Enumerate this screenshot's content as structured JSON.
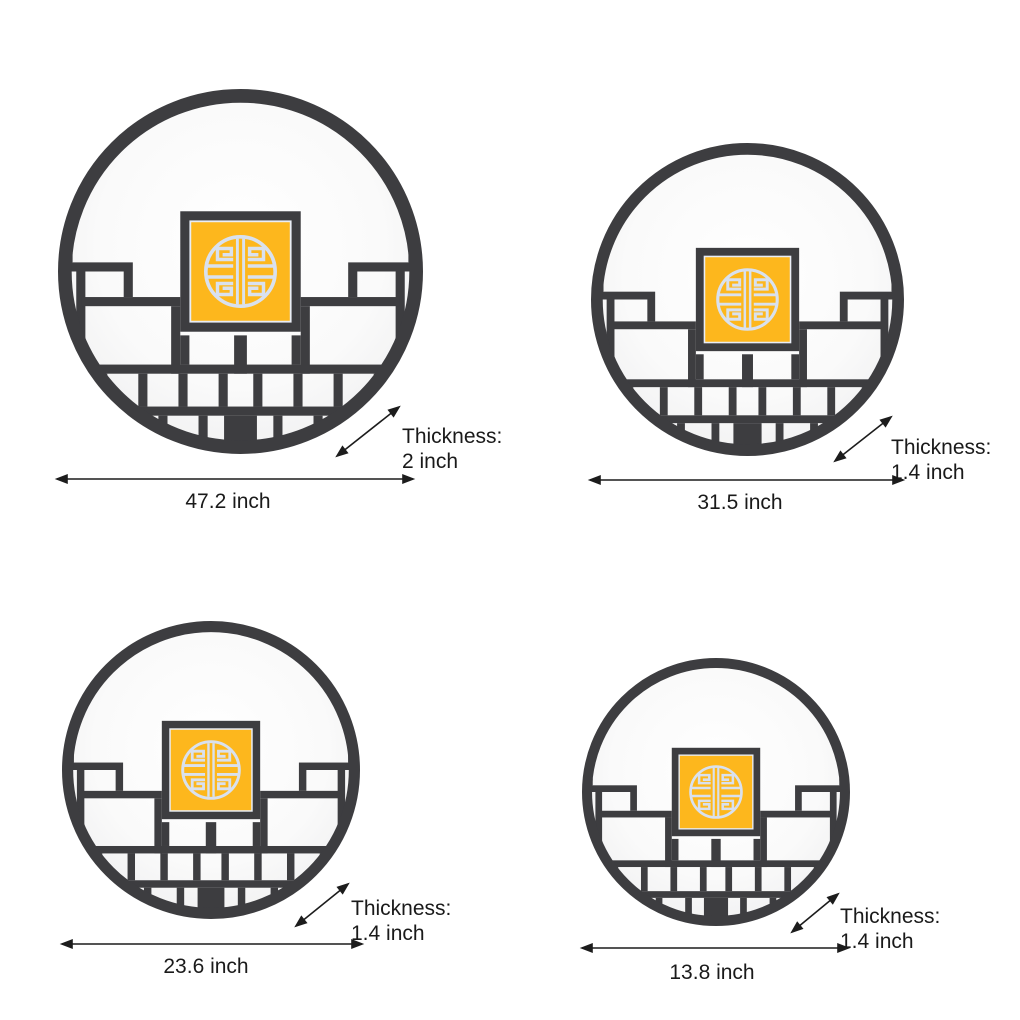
{
  "colors": {
    "frame_charcoal": "#3d3d40",
    "panel_yellow": "#fdb71d",
    "shou_symbol": "#d9e1ee",
    "inner_glow": "#ffffff",
    "inner_edge": "#e9e9eb",
    "annotation_ink": "#1a1a1a"
  },
  "icons": {
    "lamp_motif": "shou-longevity-medallion-icon",
    "arrows": "double-headed-dimension-arrow"
  },
  "products": [
    {
      "position": "top-left",
      "width_label": "47.2 inch",
      "thickness_title": "Thickness:",
      "thickness_value": "2 inch"
    },
    {
      "position": "top-right",
      "width_label": "31.5 inch",
      "thickness_title": "Thickness:",
      "thickness_value": "1.4 inch"
    },
    {
      "position": "bottom-left",
      "width_label": "23.6 inch",
      "thickness_title": "Thickness:",
      "thickness_value": "1.4 inch"
    },
    {
      "position": "bottom-right",
      "width_label": "13.8 inch",
      "thickness_title": "Thickness:",
      "thickness_value": "1.4 inch"
    }
  ]
}
